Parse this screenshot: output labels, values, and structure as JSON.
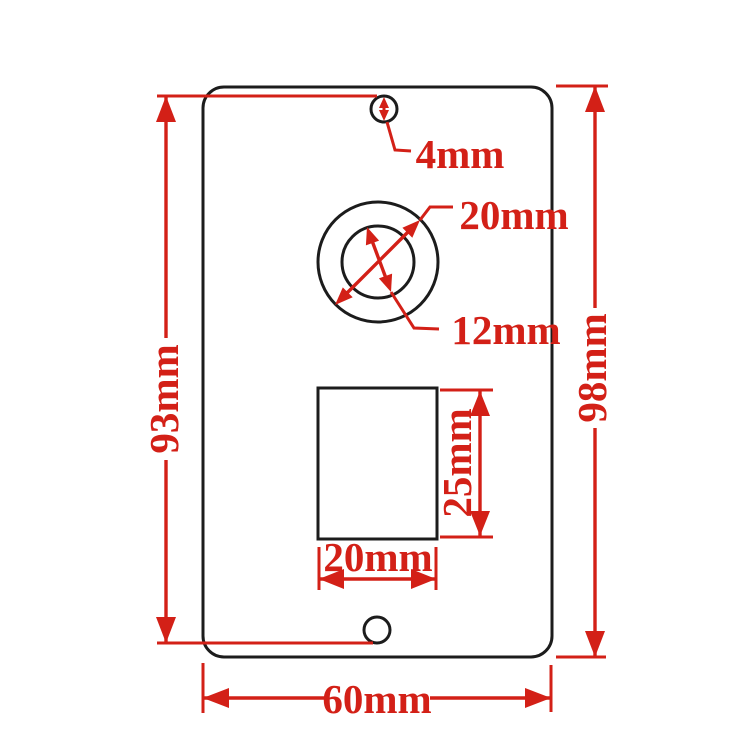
{
  "diagram": {
    "title": "plate-dimension-drawing",
    "units": "mm",
    "colors": {
      "dimension_red": "#d32017",
      "outline_black": "#1c1c1c",
      "background": "#ffffff"
    },
    "labels": {
      "top_hole_diameter": "4mm",
      "ring_outer_diameter": "20mm",
      "ring_inner_diameter": "12mm",
      "slot_height": "25mm",
      "slot_width": "20mm",
      "plate_height_hole_to_hole": "93mm",
      "plate_height_overall": "98mm",
      "plate_width_overall": "60mm"
    }
  }
}
